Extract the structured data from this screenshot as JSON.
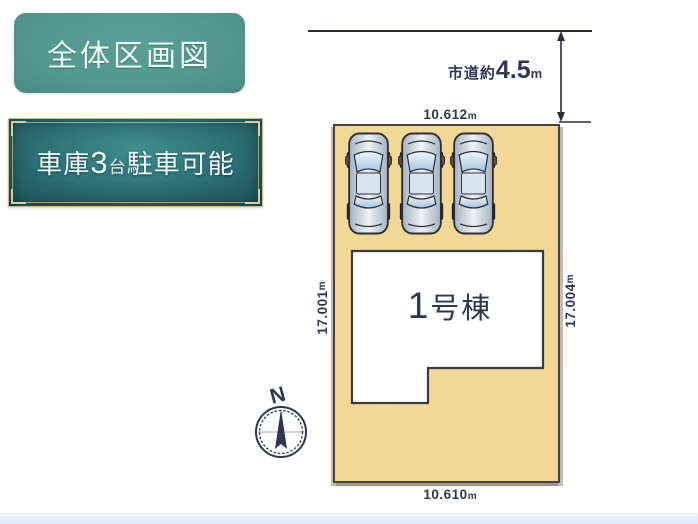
{
  "colors": {
    "teal_badge": "#54988f",
    "plaque_teal": "#2e7177",
    "gold_border": "#cabf8e",
    "plot_fill": "#f3d795",
    "navy_text": "#2f3552",
    "line_color": "#2b2d3a",
    "bottom_strip": "#e2ecf6"
  },
  "badges": {
    "title": "全体区画図",
    "garage": {
      "prefix": "車庫",
      "count": "3",
      "unit": "台",
      "suffix": "駐車可能"
    }
  },
  "road": {
    "prefix": "市道約",
    "value": "4.5",
    "unit": "m"
  },
  "dimensions": {
    "top": {
      "value": "10.612",
      "unit": "m"
    },
    "bottom": {
      "value": "10.610",
      "unit": "m"
    },
    "left": {
      "value": "17.001",
      "unit": "m"
    },
    "right": {
      "value": "17.004",
      "unit": "m"
    }
  },
  "building": {
    "number": "1",
    "suffix": "号棟"
  },
  "compass": {
    "north": "N"
  },
  "parking": {
    "car_count": 3
  }
}
